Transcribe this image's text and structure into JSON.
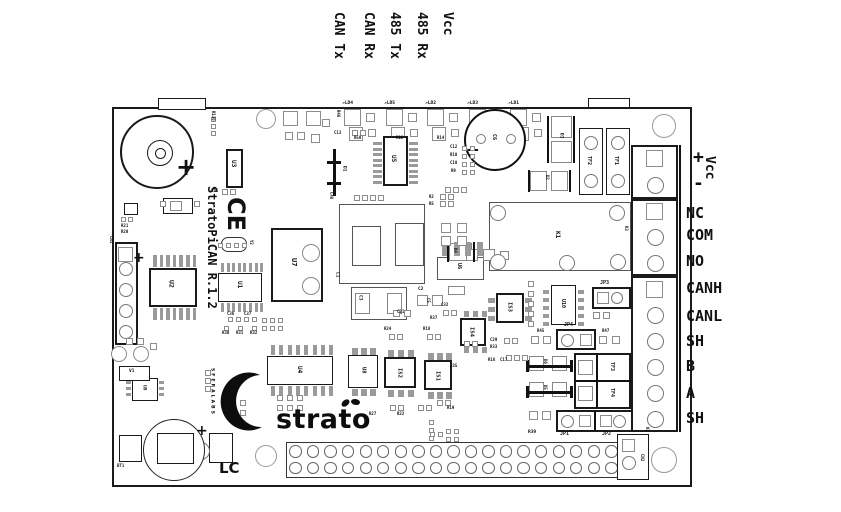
{
  "title": "StratoPiCAN R.1.2 printed circuit board layout diagram",
  "top_labels": [
    "CAN Tx",
    "CAN Rx",
    "485 Tx",
    "485 Rx",
    "Vcc"
  ],
  "right_labels": [
    "+",
    "-",
    "NC",
    "COM",
    "NO",
    "CANH",
    "CANL",
    "SH",
    "B",
    "A",
    "SH"
  ],
  "vcc_side_label": "Vcc",
  "texts": {
    "board_name": "StratoPiCAN R.1.2",
    "ce_mark": "CE",
    "logo": "strato",
    "brand": "SFERALABS",
    "battery_code": "LC",
    "buzzer_plus": "+",
    "battery_plus": "+",
    "cn1_plus": "+"
  },
  "led_labels": [
    "LD4",
    "LD5",
    "LD2",
    "LD3",
    "LD1"
  ],
  "led_resistor_labels": [
    "R50",
    "R12",
    "R14"
  ],
  "terminal_groups": [
    {
      "name": "K1",
      "pins": 2
    },
    {
      "name": "K3",
      "pins": 3
    },
    {
      "name": "K2",
      "pins": 6
    }
  ],
  "gpio_header": {
    "name": "CN2",
    "rows": 2,
    "cols": 20
  },
  "refdes": [
    "BZ1",
    "R130",
    "U3",
    "R11",
    "R21",
    "R20",
    "CN1",
    "U2",
    "U1",
    "Y2",
    "C36",
    "C37",
    "R30",
    "R31",
    "R32",
    "U7",
    "C40",
    "C13",
    "R46",
    "D1",
    "U5",
    "C12",
    "R10",
    "C10",
    "R9",
    "C6",
    "D3",
    "TF2",
    "TF1",
    "D2",
    "R2",
    "R5",
    "K1",
    "L1",
    "C3",
    "C2",
    "C5",
    "C21",
    "U6",
    "D4",
    "IS3",
    "U10",
    "JP3",
    "R45",
    "JP4",
    "R47",
    "TF3",
    "TF4",
    "D6",
    "D5",
    "R39",
    "JP1",
    "JP2",
    "K3",
    "K2",
    "CN2",
    "R24",
    "R18",
    "R37",
    "C32",
    "IS4",
    "R35",
    "U8",
    "IS2",
    "IS1",
    "R27",
    "R22",
    "R19",
    "C29",
    "R33",
    "R16",
    "C17",
    "U4",
    "U9",
    "V1",
    "BT1",
    "R17",
    "R50",
    "R12",
    "R14"
  ],
  "colors": {
    "silkscreen": "#1a1a1a",
    "pad_outline": "#8c8c8c",
    "background": "#ffffff"
  }
}
